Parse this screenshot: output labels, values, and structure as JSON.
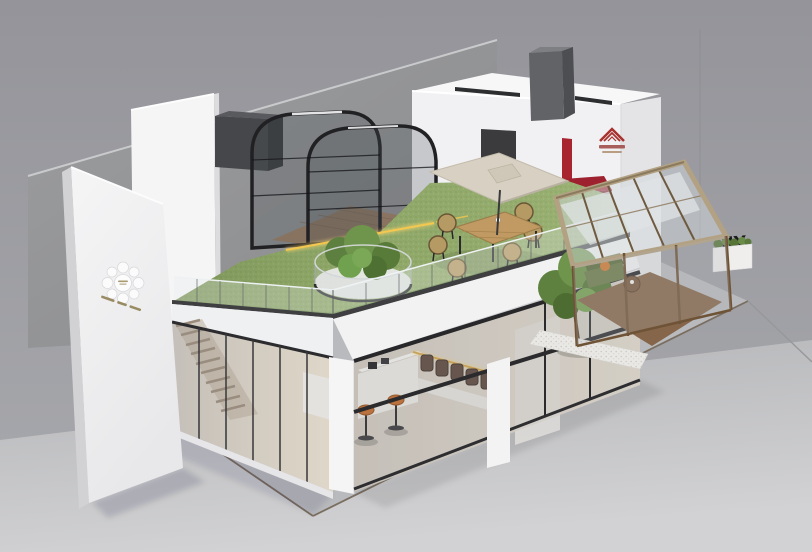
{
  "scene": {
    "description_label": "3d-architectural-render-exhibition-booth",
    "signage": {
      "letters": "JY"
    },
    "icons": {
      "sign_wall_logo": "circle-cluster-logo",
      "house_brand_logo": "striped-roof-logo"
    },
    "palette": {
      "background_wall": "#97979d",
      "floor": "#c9cacc",
      "concrete_wall": "#919294",
      "white_walls": "#f3f3f4",
      "grass_roof": "#93ab6b",
      "frame_black": "#232326",
      "frame_bronze": "#6f5336",
      "canopy_beige": "#b3a183",
      "umbrella_beige": "#d8d1c3",
      "awning_red": "#9e212f",
      "brand_red": "#a8322e",
      "led_warm": "#f0c552",
      "stool_orange": "#c86f2e",
      "sofa_green": "#6e7d4b",
      "wood_deck": "#a08166",
      "caption_gold": "#8f7f52"
    }
  }
}
